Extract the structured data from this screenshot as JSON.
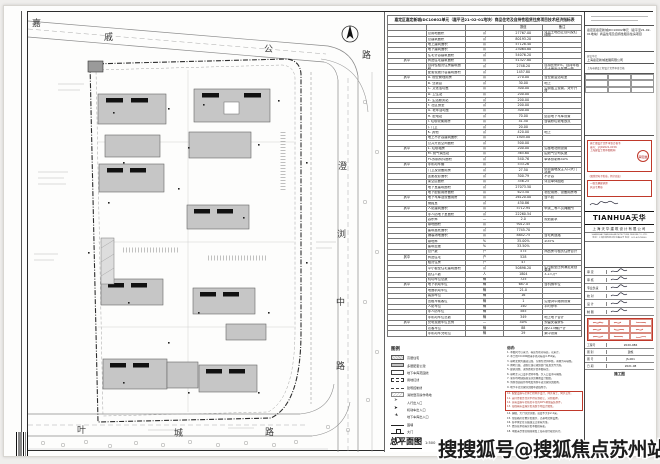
{
  "sheet": {
    "drawing_title": "总平面图",
    "drawing_scale": "1:500"
  },
  "watermark": "搜搜狐号@搜狐焦点苏州站",
  "roads": {
    "top": [
      "嘉",
      "戚",
      "公",
      "路"
    ],
    "right": [
      "澄",
      "浏",
      "中",
      "路"
    ],
    "bottom": [
      "叶",
      "城",
      "路"
    ]
  },
  "compass": {
    "north_label": "N"
  },
  "table": {
    "title": "嘉定区嘉定新城JDC10602单元（嘉平泾21-02-01地块）商品住宅及自持性租赁住房项目技术经济指标表",
    "headers": {
      "value": "数值",
      "remark": "备注"
    },
    "rows": [
      {
        "g": "",
        "label": "总用地面积",
        "unit": "㎡",
        "value": "27767.00",
        "remark": "详见土地出让合同及红线图"
      },
      {
        "g": "",
        "label": "总建筑面积",
        "unit": "㎡",
        "value": "80193.20",
        "remark": ""
      },
      {
        "g": "",
        "label": "地上建筑面积",
        "unit": "㎡",
        "value": "57128.40",
        "remark": ""
      },
      {
        "g": "",
        "label": "地下建筑面积",
        "unit": "㎡",
        "value": "23064.80",
        "remark": ""
      },
      {
        "g": "",
        "label": "住宅计容建筑面积",
        "unit": "㎡",
        "value": "54076.20",
        "remark": ""
      },
      {
        "g": "其中",
        "label": "商品住宅建筑面积",
        "unit": "㎡",
        "value": "51327.80",
        "remark": ""
      },
      {
        "g": "",
        "label": "自持性租赁住房建筑面积",
        "unit": "㎡",
        "value": "2748.20",
        "remark": "自持比例5%，自持年限与土地出让年限一致"
      },
      {
        "g": "",
        "label": "配套设施计容建筑面积",
        "unit": "㎡",
        "value": "1457.80",
        "remark": ""
      },
      {
        "g": "其中",
        "label": "A. 物业管理用房",
        "unit": "㎡",
        "value": "270.00",
        "remark": "含业委会活动室"
      },
      {
        "g": "",
        "label": "B. 业委会",
        "unit": "㎡",
        "value": "30.00",
        "remark": "地上"
      },
      {
        "g": "",
        "label": "C. 文化活动室",
        "unit": "㎡",
        "value": "300.00",
        "remark": "沿街独立设置，对外开放"
      },
      {
        "g": "",
        "label": "D. 卫生站",
        "unit": "㎡",
        "value": "200.00",
        "remark": ""
      },
      {
        "g": "",
        "label": "E. 生活服务站",
        "unit": "㎡",
        "value": "200.00",
        "remark": ""
      },
      {
        "g": "",
        "label": "F. 社区食堂",
        "unit": "㎡",
        "value": "200.00",
        "remark": ""
      },
      {
        "g": "",
        "label": "G. 老年活动室",
        "unit": "㎡",
        "value": "300.00",
        "remark": ""
      },
      {
        "g": "",
        "label": "H. 配电站",
        "unit": "㎡",
        "value": "70.00",
        "remark": "结合地下车库设置"
      },
      {
        "g": "",
        "label": "I. 垃圾收集用房",
        "unit": "㎡",
        "value": "41.50",
        "remark": "含装修垃圾堆放点"
      },
      {
        "g": "",
        "label": "J. 门卫",
        "unit": "㎡",
        "value": "20.00",
        "remark": ""
      },
      {
        "g": "",
        "label": "K. 其他",
        "unit": "㎡",
        "value": "420.00",
        "remark": "地上"
      },
      {
        "g": "",
        "label": "地上不计容建筑面积",
        "unit": "㎡",
        "value": "1505.00",
        "remark": ""
      },
      {
        "g": "",
        "label": "公共开放空间面积",
        "unit": "㎡",
        "value": "500.00",
        "remark": ""
      },
      {
        "g": "其中",
        "label": "L. 垃圾箱房",
        "unit": "㎡",
        "value": "200.00",
        "remark": "沿基地北侧设置"
      },
      {
        "g": "",
        "label": "M. 燃气调压站",
        "unit": "㎡",
        "value": "365.60",
        "remark": "由燃气公司实施"
      },
      {
        "g": "",
        "label": "PC预制构件面积",
        "unit": "㎡",
        "value": "540.76",
        "remark": "单体预制率40%"
      },
      {
        "g": "其中",
        "label": "非机动车棚",
        "unit": "㎡",
        "value": "533.26",
        "remark": ""
      },
      {
        "g": "",
        "label": "门卫及设备用房",
        "unit": "㎡",
        "value": "27.50",
        "remark": "结合围墙及主入口大门设置"
      },
      {
        "g": "",
        "label": "连廊投影面积",
        "unit": "㎡",
        "value": "300.79",
        "remark": "不计容"
      },
      {
        "g": "",
        "label": "架空层面积",
        "unit": "㎡",
        "value": "356.25",
        "remark": "详见单体图纸"
      },
      {
        "g": "",
        "label": "地下室建筑面积",
        "unit": "㎡",
        "value": "27073.50",
        "remark": ""
      },
      {
        "g": "",
        "label": "地下配套用房面积",
        "unit": "㎡",
        "value": "623.50",
        "remark": "物业用房、设备用房等"
      },
      {
        "g": "其中",
        "label": "地下车库及设备用房",
        "unit": "㎡",
        "value": "26120.00",
        "remark": "含人防"
      },
      {
        "g": "",
        "label": "储藏室",
        "unit": "㎡",
        "value": "430.86",
        "remark": ""
      },
      {
        "g": "其中",
        "label": "人防建筑面积",
        "unit": "㎡",
        "value": "5712.94",
        "remark": "甲类二等人员掩蔽所"
      },
      {
        "g": "",
        "label": "非人防地下室面积",
        "unit": "㎡",
        "value": "22260.54",
        "remark": ""
      },
      {
        "g": "",
        "label": "容积率",
        "unit": "—",
        "value": "2.0",
        "remark": "规划要求"
      },
      {
        "g": "",
        "label": "绿地面积",
        "unit": "㎡",
        "value": "9012.45",
        "remark": ""
      },
      {
        "g": "",
        "label": "建筑基底面积",
        "unit": "㎡",
        "value": "7745.70",
        "remark": ""
      },
      {
        "g": "",
        "label": "铺装场地面积",
        "unit": "㎡",
        "value": "8842.75",
        "remark": "含宅间道路"
      },
      {
        "g": "",
        "label": "绿地率",
        "unit": "%",
        "value": "35.00%",
        "remark": "≥35%"
      },
      {
        "g": "",
        "label": "建筑密度",
        "unit": "%",
        "value": "33.50%",
        "remark": ""
      },
      {
        "g": "",
        "label": "总户数",
        "unit": "户",
        "value": "575",
        "remark": "商品房与租赁住房合计"
      },
      {
        "g": "其中",
        "label": "商品住宅",
        "unit": "户",
        "value": "528",
        "remark": ""
      },
      {
        "g": "",
        "label": "租赁住房",
        "unit": "户",
        "value": "47",
        "remark": ""
      },
      {
        "g": "",
        "label": "中小套型住宅建筑面积",
        "unit": "㎡",
        "value": "50898.20",
        "remark": "中小套型比例满足规划要求"
      },
      {
        "g": "",
        "label": "居住人数",
        "unit": "人",
        "value": "1804",
        "remark": "3.2人/户"
      },
      {
        "g": "",
        "label": "机动车位总数",
        "unit": "辆",
        "value": "725",
        "remark": ""
      },
      {
        "g": "其中",
        "label": "地下机动车位",
        "unit": "辆",
        "value": "687.0",
        "remark": "含机械车位"
      },
      {
        "g": "",
        "label": "地面机动车位",
        "unit": "辆",
        "value": "21.0",
        "remark": ""
      },
      {
        "g": "",
        "label": "装卸车位",
        "unit": "辆",
        "value": "16",
        "remark": ""
      },
      {
        "g": "",
        "label": "出租车候客位",
        "unit": "辆",
        "value": "1",
        "remark": "沿澄浏中路侧设置"
      },
      {
        "g": "",
        "label": "人防车位",
        "unit": "辆",
        "value": "140",
        "remark": "平时停车"
      },
      {
        "g": "",
        "label": "非人防车位",
        "unit": "辆",
        "value": "585",
        "remark": ""
      },
      {
        "g": "",
        "label": "非机动车位总数",
        "unit": "辆",
        "value": "349",
        "remark": "地上地下合计"
      },
      {
        "g": "其中",
        "label": "充电设施车位比例",
        "unit": "—",
        "value": "40%",
        "remark": "预留安装条件"
      },
      {
        "g": "",
        "label": "访客车位",
        "unit": "辆",
        "value": "88",
        "remark": "按0.15辆/户计"
      },
      {
        "g": "",
        "label": "非机动车充电位",
        "unit": "辆",
        "value": "29",
        "remark": "集中设置"
      }
    ]
  },
  "legend": {
    "title": "图例",
    "items": [
      {
        "sym": "hl-hatch",
        "label": "高层住宅"
      },
      {
        "sym": "hl-gray",
        "label": "多层配套公建"
      },
      {
        "sym": "rect-open",
        "label": "地下车库范围线"
      },
      {
        "sym": "rect-dash",
        "label": "用地红线"
      },
      {
        "sym": "dash-line",
        "label": "建筑控制线"
      },
      {
        "sym": "hatch-area",
        "label": "消防登高操作场地"
      },
      {
        "sym": "arrow-ped",
        "label": "人行出入口"
      },
      {
        "sym": "arrow-car",
        "label": "机动车出入口"
      },
      {
        "sym": "arrow-garage",
        "label": "地下车库出入口"
      },
      {
        "sym": "wall-line",
        "label": "围墙"
      },
      {
        "sym": "gate",
        "label": "大门"
      },
      {
        "sym": "hydrant",
        "label": "室外消火栓"
      }
    ]
  },
  "notes": {
    "title": "说明：",
    "lines_a": [
      "1. 本图尺寸以米计，标高为绝对标高，以米计。",
      "2. 本工程±0.000相当于绝对标高4.350米。",
      "3. 基地北侧为嘉戚公路，东侧为澄浏中路，南侧为叶城路。",
      "4. 用地红线、道路红线以规划部门核发文件为准。",
      "5. 建筑间距、退界距离详见本图标注。",
      "6. 基地主入口设于澄浏中路，次入口设于叶城路。",
      "7. 室外场地铺装做法详见景观设计图纸。",
      "8. 消防登高操作场地及消防车道范围详见图例。",
      "9. 地下车库范围详见图中虚线所示。"
    ],
    "lines_red": [
      "10. 配套设施与主体工程同步设计、同步施工、同步交付。",
      "11. 自持性租赁住房不得分割转让、分割抵押。",
      "12. 充电设施车位按总车位的40%预留安装条件。",
      "13. 海绵城市设施详见海绵专项设计图纸。"
    ],
    "lines_b": [
      "14. 围墙、大门详见详图，高度不大于2.2米。",
      "15. 垃圾箱房位置详见图示，沿基地北侧设置。",
      "16. 各单体定位以轴线交点坐标为准。",
      "17. 经济技术指标详见本图指标表。",
      "18. 本图未尽事宜按国家及上海市现行规范执行。"
    ]
  },
  "titleblock": {
    "project_label": "项目名称",
    "project_name": "嘉定区嘉定新城JDC10602单元（嘉平泾21-02-01地块）商品住宅及自持性租赁住房项目",
    "client_label": "建设单位",
    "client": "上海嘉定新城发展有限公司",
    "approval_line": "上海市建设工程设计文件审查合格",
    "stamp1_lines": [
      "施工图设计文件审查合格书",
      "编号：沪JD2021-0156",
      "上海建设工程审图机构"
    ],
    "stamp1_seal": "审图章",
    "stamp_note": "（图纸经电子签章，复印无效）",
    "stamp2_lines": [
      "一级注册建筑师",
      "执业专用章"
    ],
    "logo": "TIANHUA天华",
    "company": "上海天华建筑设计有限公司",
    "company_lines": [
      "SHANGHAI TIANHUA ARCHITECTURE DESIGN CO.,LTD.",
      "地址：上海市普陀区云岭东路89号  电话：021-62578800"
    ],
    "sign_rows": [
      "审 定",
      "审 核",
      "专业负责",
      "校 对",
      "设 计",
      "制 图"
    ],
    "fields": [
      {
        "label": "工程号",
        "value": "2020-086"
      },
      {
        "label": "图 别",
        "value": "建施"
      },
      {
        "label": "图 号",
        "value": "JS-001"
      },
      {
        "label": "日 期",
        "value": "2021.08"
      }
    ],
    "stage": "施工图"
  }
}
